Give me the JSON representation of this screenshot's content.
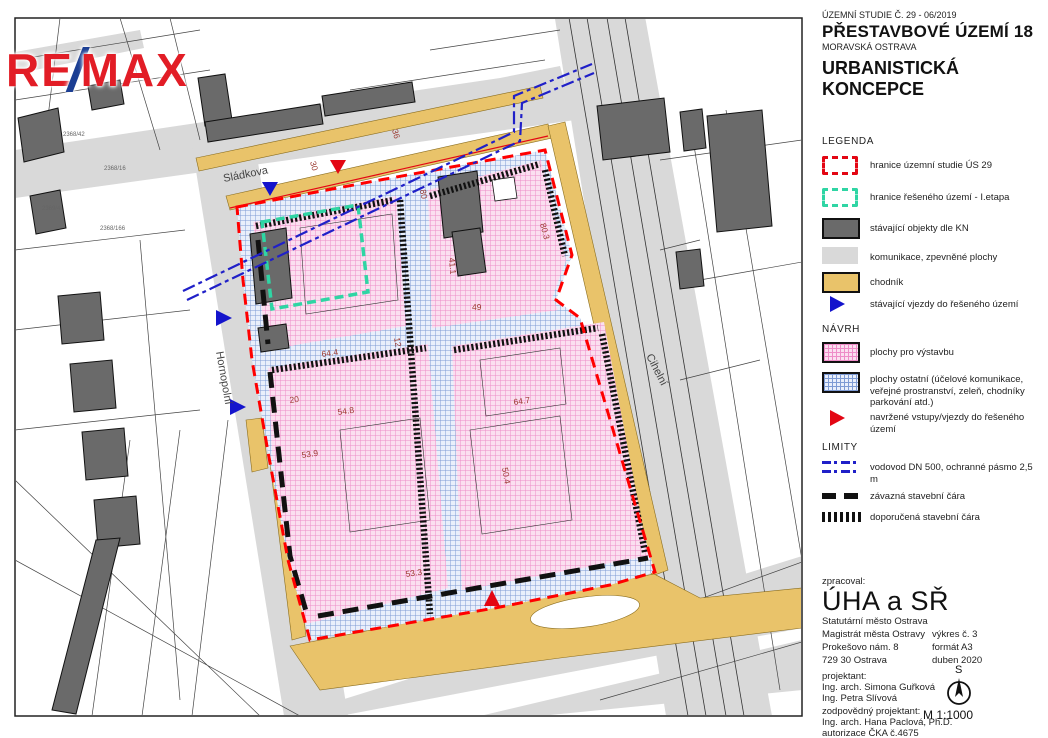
{
  "colors": {
    "brand_red": "#e21d26",
    "brand_blue": "#1b3e93",
    "boundary_red": "#e30613",
    "etapa_teal": "#2fd5a4",
    "existing_building_gray": "#6a6a6a",
    "road_gray": "#d9d9d9",
    "sidewalk_tan": "#e9c36a",
    "build_pink": "#fbdff0",
    "other_blue": "#e9effb",
    "vodovod_blue": "#2020c8"
  },
  "logo": {
    "re": "RE",
    "slash": "/",
    "max": "MAX"
  },
  "title_block": {
    "study_ref": "ÚZEMNÍ STUDIE Č. 29 - 06/2019",
    "title": "PŘESTAVBOVÉ ÚZEMÍ 18",
    "subtitle": "MORAVSKÁ OSTRAVA",
    "concept_line1": "URBANISTICKÁ",
    "concept_line2": "KONCEPCE"
  },
  "legend": {
    "heading": "LEGENDA",
    "items": [
      {
        "label": "hranice územní studie ÚS 29"
      },
      {
        "label": "hranice řešeného území - I.etapa"
      },
      {
        "label": "stávající objekty dle KN"
      },
      {
        "label": "komunikace, zpevněné plochy"
      },
      {
        "label": "chodník"
      },
      {
        "label": "stávající vjezdy do řešeného území"
      }
    ]
  },
  "navrh": {
    "heading": "NÁVRH",
    "items": [
      {
        "label": "plochy pro výstavbu"
      },
      {
        "label": "plochy ostatní (účelové komunikace, veřejné prostranství, zeleň, chodníky parkování atd.)"
      },
      {
        "label": "navržené vstupy/vjezdy do řešeného území"
      }
    ]
  },
  "limity": {
    "heading": "LIMITY",
    "items": [
      {
        "label": "vodovod DN 500, ochranné pásmo 2,5 m"
      },
      {
        "label": "závazná stavební čára"
      },
      {
        "label": "doporučená stavební čára"
      }
    ]
  },
  "credits": {
    "prepared_label": "zpracoval:",
    "org": "ÚHA a SŘ",
    "org_lines": [
      "Statutární město Ostrava",
      "Magistrát města Ostravy",
      "Prokešovo nám. 8",
      "729 30 Ostrava"
    ],
    "meta": [
      "výkres č. 3",
      "formát A3",
      "duben 2020"
    ],
    "projektant_label": "projektant:",
    "projektant_names": [
      "Ing. arch. Simona Guřková",
      "Ing. Petra Slívová"
    ],
    "responsible_label": "zodpovědný projektant:",
    "responsible_names": [
      "Ing. arch. Hana Paclová, Ph.D.",
      "autorizace ČKA č.4675"
    ]
  },
  "compass": {
    "north": "S",
    "scale": "M 1:1000"
  },
  "map": {
    "streets": [
      "Sládkova",
      "Hornopolní",
      "Cihelní"
    ],
    "dimensions": [
      "30",
      "36",
      "80",
      "80.3",
      "41.1",
      "49",
      "12",
      "64.4",
      "20",
      "54.8",
      "53.9",
      "53.3",
      "64.7",
      "50.4"
    ],
    "parcels": [
      "2368/42",
      "2368/16",
      "2369/4",
      "2368/166"
    ]
  }
}
